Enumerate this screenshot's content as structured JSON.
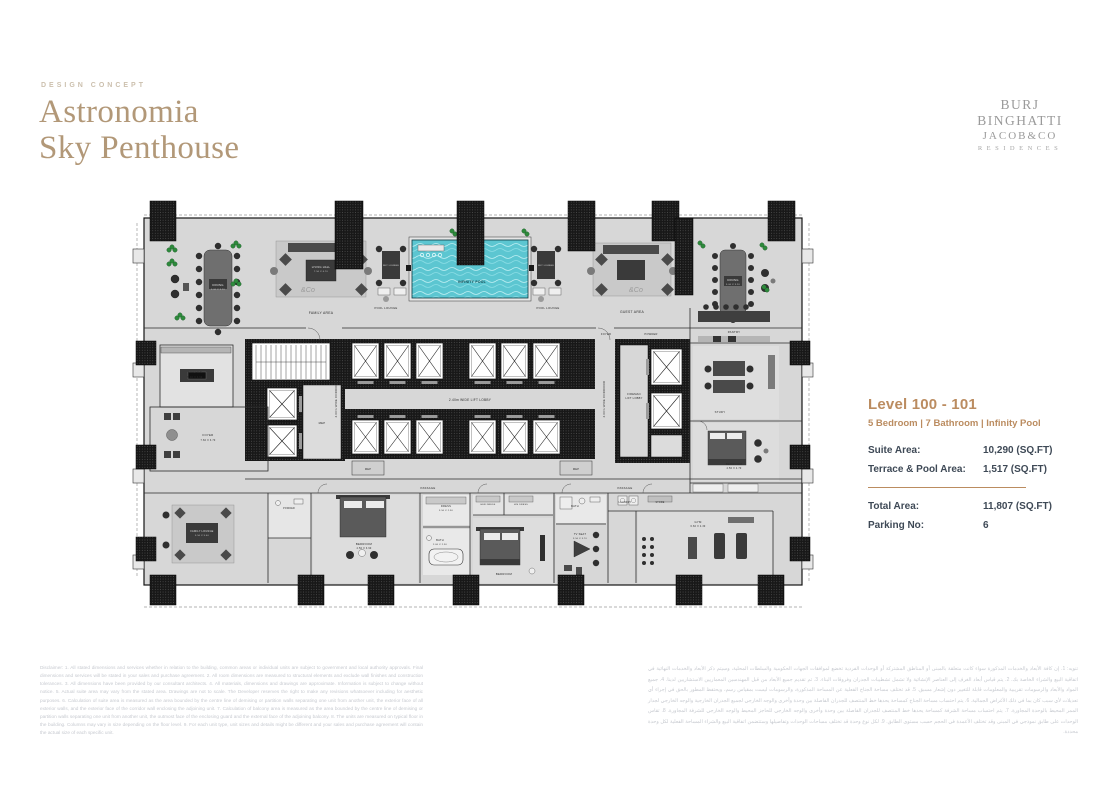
{
  "header": {
    "eyebrow": "DESIGN CONCEPT",
    "title_line1": "Astronomia",
    "title_line2": "Sky Penthouse",
    "brand_line1": "BURJ BINGHATTI",
    "brand_line2": "JACOB&CO",
    "brand_line3": "RESIDENCES"
  },
  "info_panel": {
    "level_title": "Level 100 - 101",
    "subtitle": "5 Bedroom | 7 Bathroom | Infinity Pool",
    "rows_top": [
      {
        "label": "Suite Area:",
        "value": "10,290 (SQ.FT)"
      },
      {
        "label": "Terrace & Pool Area:",
        "value": "1,517 (SQ.FT)"
      }
    ],
    "rows_bottom": [
      {
        "label": "Total Area:",
        "value": "11,807 (SQ.FT)"
      },
      {
        "label": "Parking No:",
        "value": "6"
      }
    ]
  },
  "colors": {
    "accent_tan": "#b29878",
    "bronze": "#bb8c60",
    "slate": "#3e4956",
    "pool_teal": "#5cc6d1"
  },
  "floorplan": {
    "labels": [
      {
        "t": "FAMILY AREA",
        "x": 193,
        "y": 121
      },
      {
        "t": "POOL LOUNGE",
        "x": 258,
        "y": 116,
        "s": 2.8
      },
      {
        "t": "POOL LOUNGE",
        "x": 420,
        "y": 116,
        "s": 2.8
      },
      {
        "t": "INFINITY POOL",
        "x": 344,
        "y": 90,
        "s": 3.4,
        "c": "#12474e",
        "w": 1
      },
      {
        "t": "DINING",
        "x": 90,
        "y": 93,
        "s": 2.8,
        "c": "#e8e8e8"
      },
      {
        "t": "5.00 X 3.20",
        "x": 90,
        "y": 97,
        "s": 2.2,
        "c": "#cfcfcf"
      },
      {
        "t": "LIVING HALL",
        "x": 193,
        "y": 75,
        "s": 2.6,
        "c": "#e8e8e8"
      },
      {
        "t": "7.50 X 6.70",
        "x": 193,
        "y": 79,
        "s": 2.2,
        "c": "#cfcfcf"
      },
      {
        "t": "SKY LOUNGE",
        "x": 263,
        "y": 73,
        "s": 2.1,
        "c": "#e0e0e0"
      },
      {
        "t": "SKY LOUNGE",
        "x": 418,
        "y": 73,
        "s": 2.1,
        "c": "#e0e0e0"
      },
      {
        "t": "GUEST AREA",
        "x": 504,
        "y": 120
      },
      {
        "t": "DINING",
        "x": 605,
        "y": 88,
        "s": 2.8,
        "c": "#e8e8e8"
      },
      {
        "t": "5.00 X 3.20",
        "x": 605,
        "y": 92,
        "s": 2.2,
        "c": "#cfcfcf"
      },
      {
        "t": "PANTRY",
        "x": 606,
        "y": 140,
        "s": 2.8
      },
      {
        "t": "KITCHEN",
        "x": 67,
        "y": 180,
        "s": 2.8
      },
      {
        "t": "5.40 X 3.90",
        "x": 67,
        "y": 185,
        "s": 2.4
      },
      {
        "t": "FOYER",
        "x": 80,
        "y": 243,
        "s": 2.8
      },
      {
        "t": "7.60 X 3.70",
        "x": 80,
        "y": 248,
        "s": 2.4
      },
      {
        "t": "MEP",
        "x": 194,
        "y": 231,
        "s": 2.8
      },
      {
        "t": "2.40m WIDE LIFT LOBBY",
        "x": 342,
        "y": 208,
        "s": 3.2
      },
      {
        "t": "2.00m WIDE CORRIDOR",
        "x": 209,
        "y": 206,
        "s": 2.8,
        "r": -90
      },
      {
        "t": "2.00m WIDE CORRIDOR",
        "x": 477,
        "y": 206,
        "s": 2.8,
        "r": -90
      },
      {
        "t": "FIREMAN",
        "x": 506,
        "y": 202,
        "s": 2.6
      },
      {
        "t": "LIFT LOBBY",
        "x": 506,
        "y": 206,
        "s": 2.6
      },
      {
        "t": "FOYER",
        "x": 478,
        "y": 142,
        "s": 2.6
      },
      {
        "t": "POWDER",
        "x": 523,
        "y": 142,
        "s": 2.6
      },
      {
        "t": "MEP",
        "x": 240,
        "y": 277,
        "s": 2.6
      },
      {
        "t": "MEP",
        "x": 448,
        "y": 277,
        "s": 2.6
      },
      {
        "t": "PASSAGE",
        "x": 300,
        "y": 296,
        "s": 2.8
      },
      {
        "t": "PASSAGE",
        "x": 497,
        "y": 296,
        "s": 2.8
      },
      {
        "t": "FAMILY LOUNGE",
        "x": 74,
        "y": 339,
        "s": 2.5,
        "c": "#e0e0e0"
      },
      {
        "t": "5.50 X 5.40",
        "x": 74,
        "y": 343,
        "s": 2.2,
        "c": "#cfcfcf"
      },
      {
        "t": "POWDER",
        "x": 161,
        "y": 316,
        "s": 2.3
      },
      {
        "t": "BEDROOM",
        "x": 236,
        "y": 352,
        "s": 2.8
      },
      {
        "t": "4.50 X 3.90",
        "x": 236,
        "y": 356,
        "s": 2.4
      },
      {
        "t": "DRESS",
        "x": 318,
        "y": 314,
        "s": 2.6
      },
      {
        "t": "3.50 X 2.30",
        "x": 318,
        "y": 318,
        "s": 2.2
      },
      {
        "t": "BATH",
        "x": 312,
        "y": 348,
        "s": 2.6
      },
      {
        "t": "2.60 X 2.30",
        "x": 312,
        "y": 352,
        "s": 2.2
      },
      {
        "t": "HER DRESS",
        "x": 360,
        "y": 312,
        "s": 2.2
      },
      {
        "t": "HIS DRESS",
        "x": 393,
        "y": 312,
        "s": 2.2
      },
      {
        "t": "BEDROOM",
        "x": 376,
        "y": 382,
        "s": 2.8
      },
      {
        "t": "BATH",
        "x": 447,
        "y": 314,
        "s": 2.6
      },
      {
        "t": "TV SEAT",
        "x": 452,
        "y": 342,
        "s": 2.6
      },
      {
        "t": "3.50 X 3.70",
        "x": 452,
        "y": 346,
        "s": 2.2
      },
      {
        "t": "LAUNDRY",
        "x": 497,
        "y": 310,
        "s": 2.3
      },
      {
        "t": "STORE",
        "x": 532,
        "y": 310,
        "s": 2.3
      },
      {
        "t": "GYM",
        "x": 570,
        "y": 330,
        "s": 2.8
      },
      {
        "t": "6.60 X 4.30",
        "x": 570,
        "y": 334,
        "s": 2.4
      },
      {
        "t": "BEDROOM",
        "x": 606,
        "y": 272,
        "s": 2.8
      },
      {
        "t": "4.50 X 4.70",
        "x": 606,
        "y": 276,
        "s": 2.4
      },
      {
        "t": "STUDY",
        "x": 592,
        "y": 220,
        "s": 2.8
      },
      {
        "t": "&Co",
        "x": 180,
        "y": 99,
        "s": 7,
        "c": "#9a9a9a",
        "f": 1
      },
      {
        "t": "&Co",
        "x": 508,
        "y": 99,
        "s": 7,
        "c": "#9a9a9a",
        "f": 1
      }
    ]
  },
  "disclaimer_en": "Disclaimer: 1. All stated dimensions and services whether in relation to the building, common areas or individual units are subject to government and local authority approvals. Final dimensions and services will be stated in your sales and purchase agreement. 2. All room dimensions are measured to structural elements and exclude wall finishes and construction tolerances. 3. All dimensions have been provided by our consultant architects. 4. All materials, dimensions and drawings are approximate. Information is subject to change without notice. 5. Actual suite area may vary from the stated area. Drawings are not to scale. The Developer reserves the right to make any revisions whatsoever including for aesthetic purposes. 6. Calculation of suite area is measured as the area bounded by the centre line of demising or partition walls separating one unit from another unit, the exterior face of all exterior walls, and the exterior face of the corridor wall enclosing the adjoining unit. 7. Calculation of balcony area is measured as the area bounded by the centre line of demising or partition walls separating one unit from another unit, the outmost face of the enclosing guard and the external face of the adjoining balcony. 8. The units are measured on typical floor in the building. Columns may vary in size depending on the floor level. 9. For each unit type, unit sizes and details might be different and your sales and purchase agreement will contain the actual size of each specific unit.",
  "disclaimer_ar": "تنويه: 1. إن كافة الأبعاد والخدمات المذكورة سواء كانت متعلقة بالمبنى أو المناطق المشتركة أو الوحدات الفردية تخضع لموافقات الجهات الحكومية والسلطات المحلية، وسيتم ذكر الأبعاد والخدمات النهائية في اتفاقية البيع والشراء الخاصة بك. 2. يتم قياس أبعاد الغرف إلى العناصر الإنشائية ولا تشمل تشطيبات الجدران وفروقات البناء. 3. تم تقديم جميع الأبعاد من قبل المهندسين المعماريين الاستشاريين لدينا. 4. جميع المواد والأبعاد والرسومات تقريبية والمعلومات قابلة للتغيير دون إشعار مسبق. 5. قد تختلف مساحة الجناح الفعلية عن المساحة المذكورة، والرسومات ليست بمقياس رسم، ويحتفظ المطور بالحق في إجراء أي تعديلات لأي سبب كان بما في ذلك الأغراض الجمالية. 6. يتم احتساب مساحة الجناح كمساحة يحدها خط المنتصف للجدران الفاصلة بين وحدة وأخرى والوجه الخارجي لجميع الجدران الخارجية والوجه الخارجي لجدار الممر المحيط بالوحدة المجاورة. 7. يتم احتساب مساحة الشرفة كمساحة يحدها خط المنتصف للجدران الفاصلة بين وحدة وأخرى والوجه الخارجي للحاجز المحيط والوجه الخارجي للشرفة المجاورة. 8. تقاس الوحدات على طابق نموذجي في المبنى وقد تختلف الأعمدة في الحجم حسب مستوى الطابق. 9. لكل نوع وحدة قد تختلف مساحات الوحدات وتفاصيلها وستتضمن اتفاقية البيع والشراء المساحة الفعلية لكل وحدة محددة."
}
